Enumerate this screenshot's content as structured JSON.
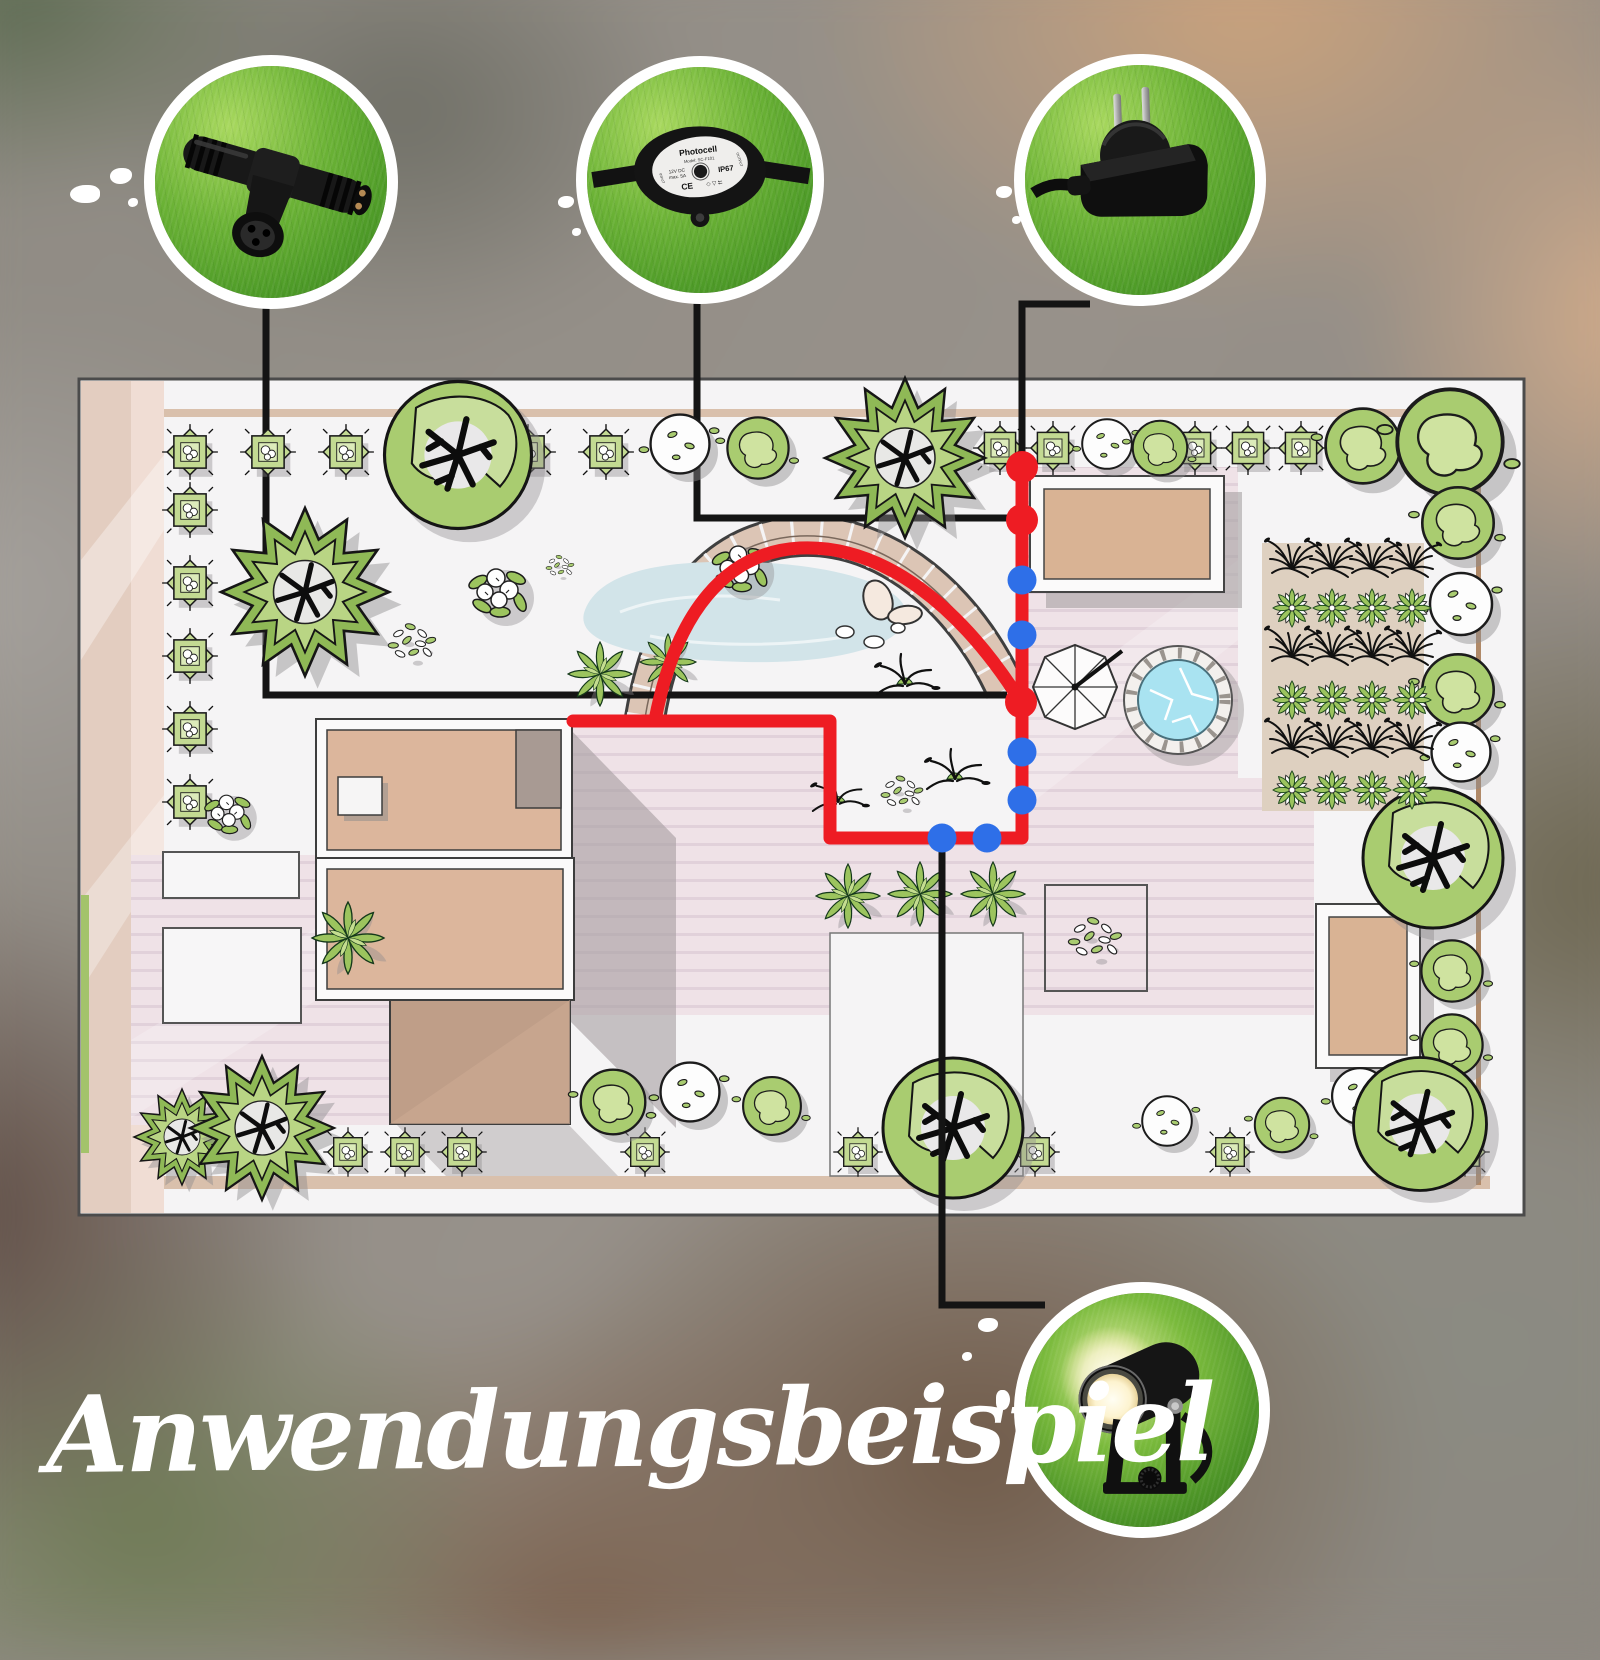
{
  "title": "Anwendungsbeispiel",
  "colors": {
    "cable_red": "#ee1c23",
    "dot_blue": "#2e6fe8",
    "callout_black": "#141414",
    "ring_white": "#ffffff"
  },
  "photocell_label": {
    "title": "Photocell",
    "model": "Model: SC-F101",
    "volt": "12V DC",
    "amp": "max. 5A",
    "ip": "IP67",
    "ce": "CE",
    "marks": "◇ ▽ ⮄",
    "input": "INPUT",
    "output": "OUTPUT"
  },
  "products": [
    {
      "id": "t-connector-photo"
    },
    {
      "id": "photocell-photo"
    },
    {
      "id": "power-plug-photo"
    },
    {
      "id": "spotlight-photo"
    }
  ],
  "cable": {
    "main_path": "M1022,467 V838 H830 V721 H573",
    "arc_path": "M655,720 C676,612 726,552 800,548 C884,544 962,608 1021,702",
    "red_dots": [
      [
        1022,
        467
      ],
      [
        1022,
        520
      ],
      [
        1021,
        702
      ]
    ],
    "blue_dots": [
      [
        1022,
        580
      ],
      [
        1022,
        635
      ],
      [
        1022,
        752
      ],
      [
        1022,
        800
      ],
      [
        987,
        838
      ],
      [
        942,
        838
      ]
    ]
  },
  "callouts": {
    "under": [
      "M266,302 L266,695 L1007,695",
      "M697,296 L697,518 L1007,518"
    ],
    "over": [
      "M1090,304 L1022,304 L1022,452",
      "M942,845 L942,1305 L1045,1305"
    ]
  },
  "plan": {
    "plants": [
      [
        "sq",
        190,
        452,
        0.62
      ],
      [
        "sq",
        268,
        452,
        0.62
      ],
      [
        "sq",
        346,
        452,
        0.62
      ],
      [
        "sq",
        528,
        452,
        0.62
      ],
      [
        "sq",
        606,
        452,
        0.62
      ],
      [
        "sq",
        1000,
        448,
        0.6
      ],
      [
        "sq",
        1053,
        448,
        0.6
      ],
      [
        "sq",
        1195,
        448,
        0.6
      ],
      [
        "sq",
        1248,
        448,
        0.6
      ],
      [
        "sq",
        1301,
        448,
        0.6
      ],
      [
        "wb",
        680,
        444,
        0.95
      ],
      [
        "gb",
        758,
        448,
        0.9
      ],
      [
        "wb",
        1107,
        444,
        0.8
      ],
      [
        "gb",
        1160,
        448,
        0.8
      ],
      [
        "gb",
        1363,
        446,
        1.1
      ],
      [
        "bt",
        458,
        455,
        1.05
      ],
      [
        "st",
        905,
        458,
        1.0
      ],
      [
        "gb",
        1450,
        442,
        1.55
      ],
      [
        "sq",
        190,
        510,
        0.62
      ],
      [
        "sq",
        190,
        583,
        0.62
      ],
      [
        "sq",
        190,
        656,
        0.62
      ],
      [
        "sq",
        190,
        729,
        0.62
      ],
      [
        "sq",
        190,
        802,
        0.62
      ],
      [
        "st",
        305,
        592,
        1.05
      ],
      [
        "fb",
        498,
        590,
        1.0
      ],
      [
        "lb",
        412,
        642,
        0.85
      ],
      [
        "lb",
        560,
        566,
        0.5
      ],
      [
        "fb",
        740,
        566,
        0.95
      ],
      [
        "fn",
        600,
        674,
        0.8
      ],
      [
        "fn",
        668,
        662,
        0.7
      ],
      [
        "gt",
        905,
        684,
        1
      ],
      [
        "gt",
        955,
        779,
        1
      ],
      [
        "gt",
        838,
        802,
        0.9
      ],
      [
        "lb",
        902,
        792,
        0.75
      ],
      [
        "fb",
        228,
        812,
        0.8
      ],
      [
        "fn",
        348,
        938,
        0.9
      ],
      [
        "fn",
        848,
        896,
        0.8
      ],
      [
        "fn",
        920,
        894,
        0.8
      ],
      [
        "fn",
        993,
        894,
        0.8
      ],
      [
        "lb",
        1095,
        938,
        0.95
      ],
      [
        "gb",
        1458,
        523,
        1.05
      ],
      [
        "wb",
        1461,
        604,
        1.0
      ],
      [
        "gb",
        1458,
        690,
        1.05
      ],
      [
        "wb",
        1461,
        752,
        0.95
      ],
      [
        "bt",
        1433,
        858,
        1.0
      ],
      [
        "gb",
        1452,
        971,
        0.9
      ],
      [
        "gb",
        1452,
        1045,
        0.9
      ],
      [
        "st",
        182,
        1137,
        0.6
      ],
      [
        "st",
        262,
        1128,
        0.9
      ],
      [
        "sq",
        348,
        1152,
        0.55
      ],
      [
        "sq",
        405,
        1152,
        0.55
      ],
      [
        "sq",
        462,
        1152,
        0.55
      ],
      [
        "sq",
        645,
        1152,
        0.55
      ],
      [
        "sq",
        858,
        1152,
        0.55
      ],
      [
        "sq",
        1035,
        1152,
        0.55
      ],
      [
        "sq",
        1230,
        1152,
        0.55
      ],
      [
        "sq",
        1465,
        1152,
        0.55
      ],
      [
        "gb",
        613,
        1102,
        0.95
      ],
      [
        "wb",
        690,
        1092,
        0.95
      ],
      [
        "gb",
        772,
        1106,
        0.85
      ],
      [
        "bt",
        953,
        1128,
        1.0
      ],
      [
        "wb",
        1167,
        1121,
        0.8
      ],
      [
        "gb",
        1282,
        1125,
        0.8
      ],
      [
        "wb",
        1360,
        1096,
        0.9
      ],
      [
        "bt",
        1420,
        1124,
        0.95
      ]
    ],
    "veg": {
      "x0": 1292,
      "dx": 40,
      "cols": 4,
      "rows": [
        {
          "y": 567,
          "t": "vb"
        },
        {
          "y": 608,
          "t": "vg"
        },
        {
          "y": 655,
          "t": "vb"
        },
        {
          "y": 700,
          "t": "vg"
        },
        {
          "y": 747,
          "t": "vb"
        },
        {
          "y": 790,
          "t": "vg"
        }
      ]
    }
  }
}
